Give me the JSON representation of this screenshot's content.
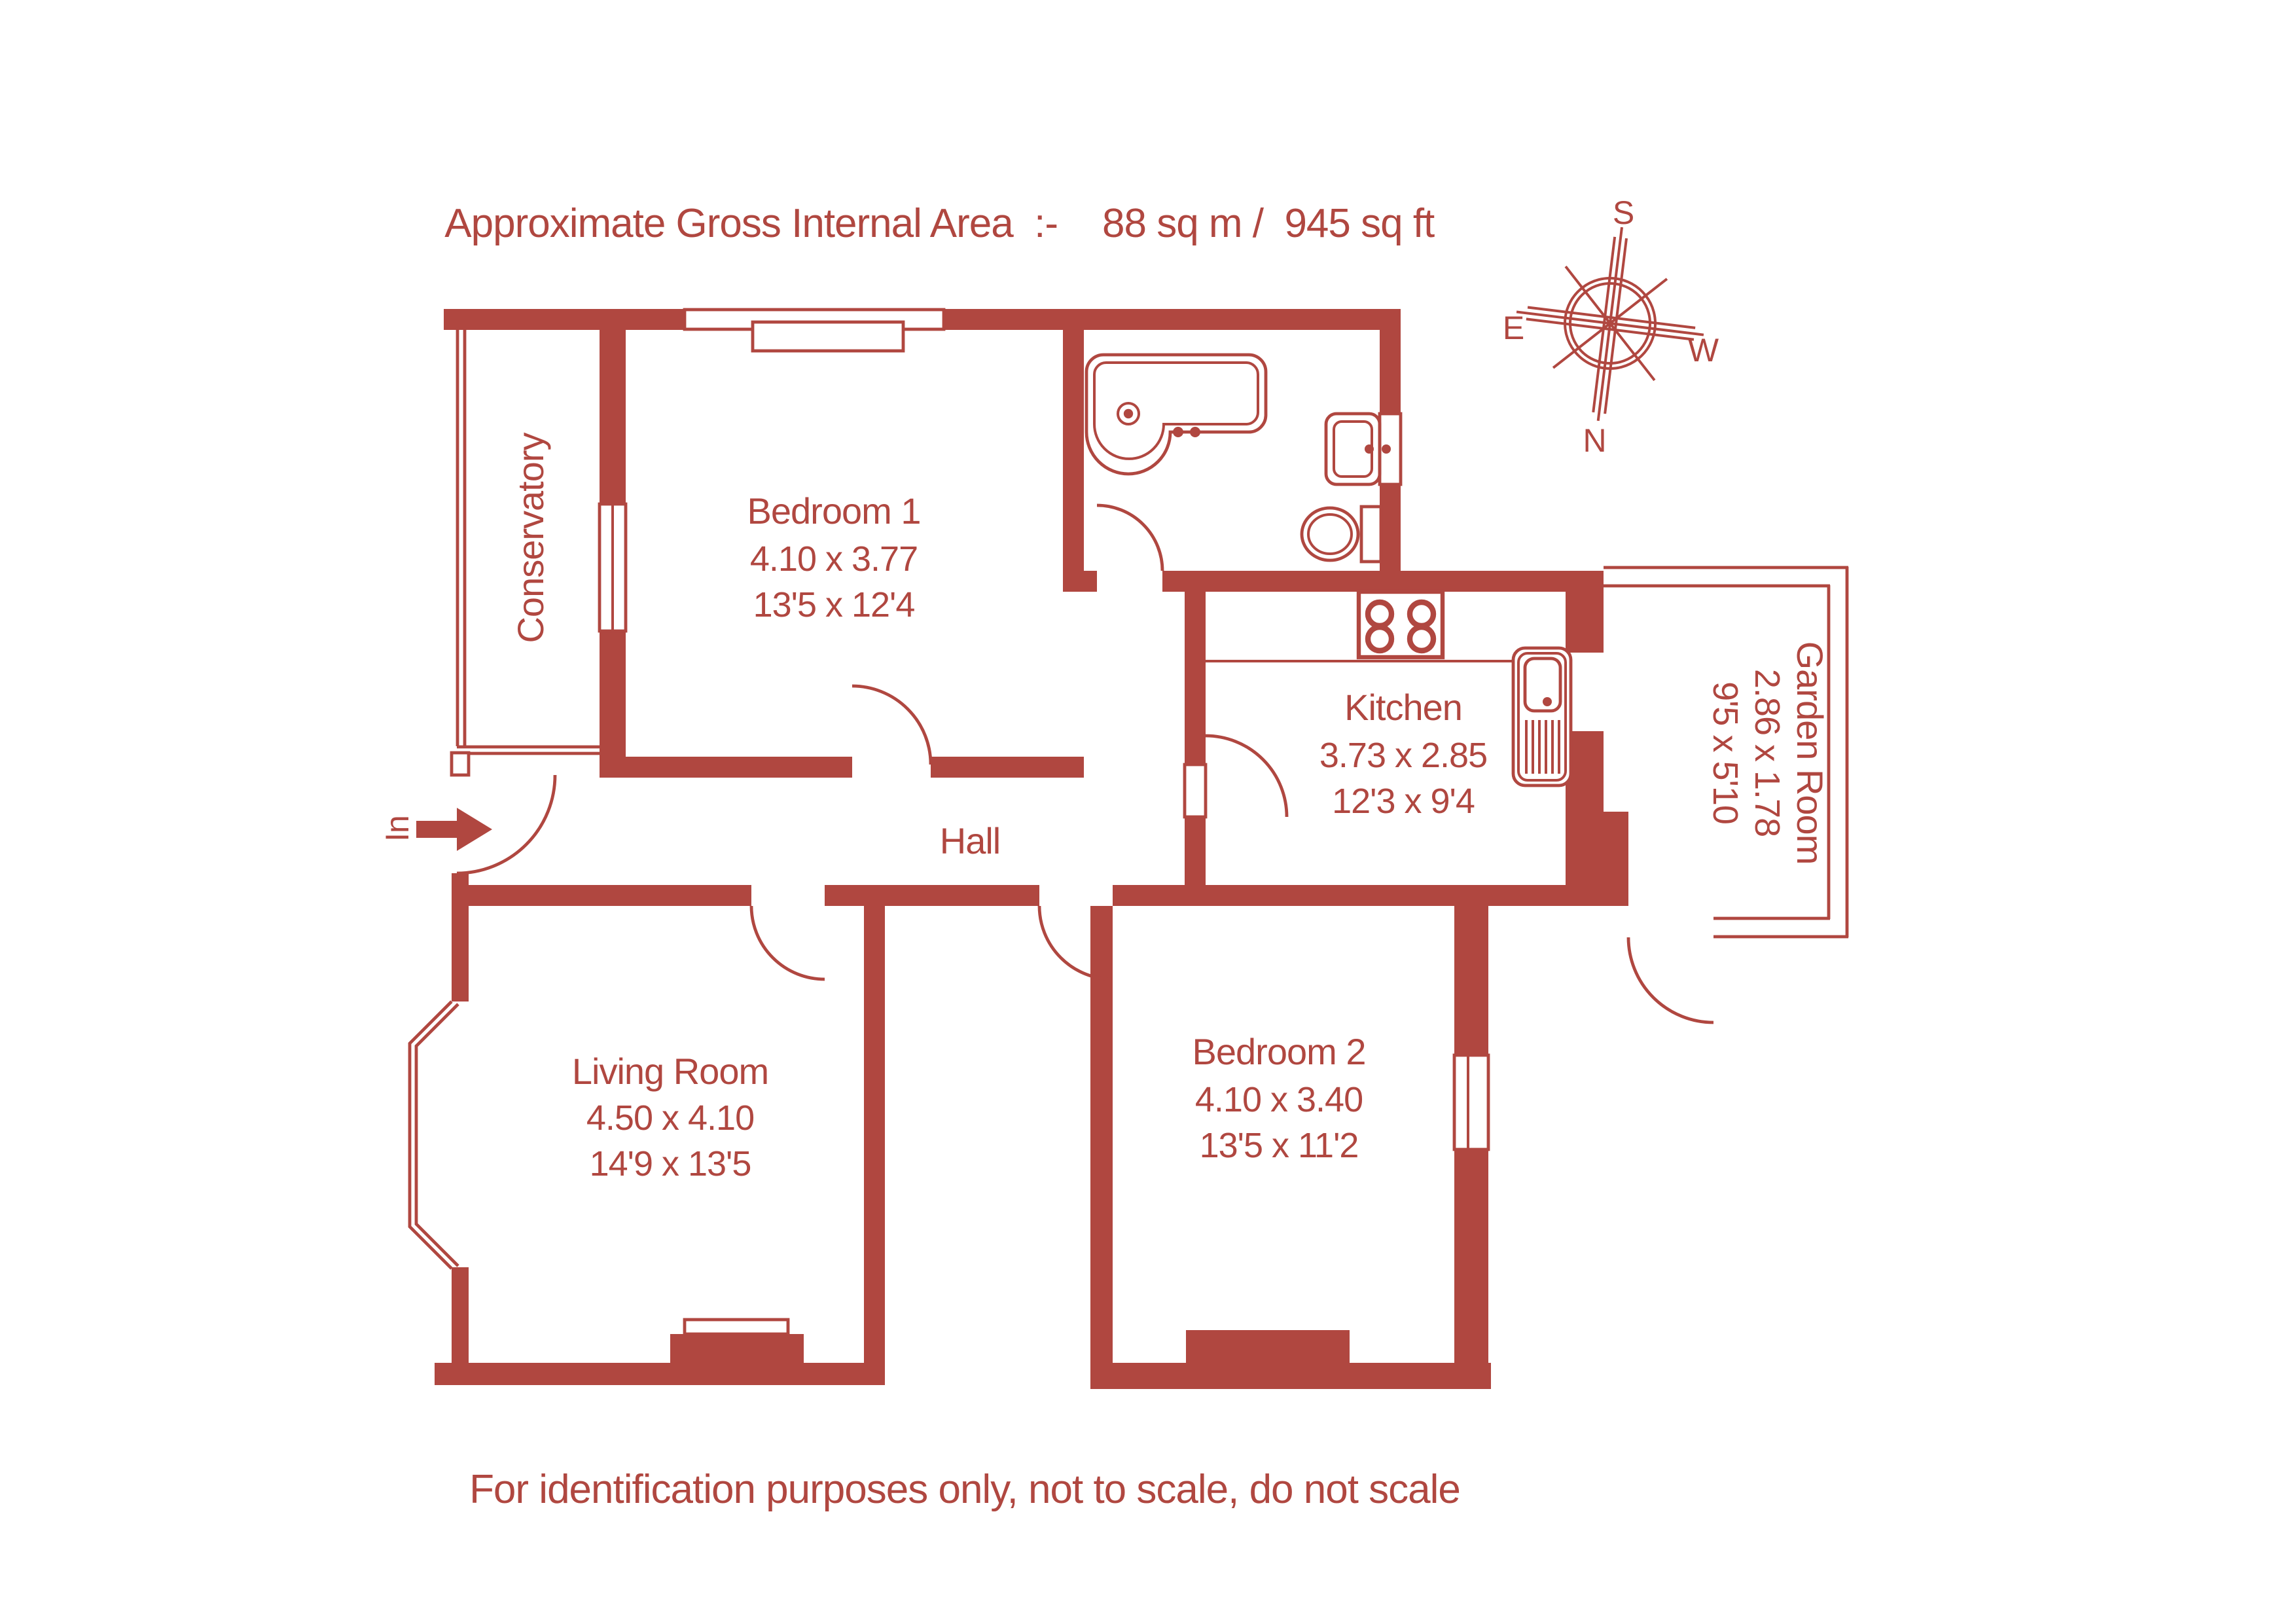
{
  "title": {
    "label": "Approximate Gross Internal Area  :-",
    "value": "88 sq m /  945 sq ft"
  },
  "footer": "For identification purposes only, not to scale, do not scale",
  "accent_color": "#b04740",
  "compass": {
    "north": "N",
    "south": "S",
    "east": "E",
    "west": "W"
  },
  "entrance": {
    "label": "In"
  },
  "rooms": {
    "conservatory": {
      "name": "Conservatory"
    },
    "bedroom1": {
      "name": "Bedroom 1",
      "metric": "4.10 x 3.77",
      "imperial": "13'5 x 12'4"
    },
    "bathroom": {
      "name": ""
    },
    "kitchen": {
      "name": "Kitchen",
      "metric": "3.73 x 2.85",
      "imperial": "12'3 x 9'4"
    },
    "garden_room": {
      "name": "Garden Room",
      "metric": "2.86 x 1.78",
      "imperial": "9'5 x 5'10"
    },
    "hall": {
      "name": "Hall"
    },
    "living_room": {
      "name": "Living Room",
      "metric": "4.50 x 4.10",
      "imperial": "14'9 x 13'5"
    },
    "bedroom2": {
      "name": "Bedroom 2",
      "metric": "4.10 x 3.40",
      "imperial": "13'5 x 11'2"
    }
  }
}
